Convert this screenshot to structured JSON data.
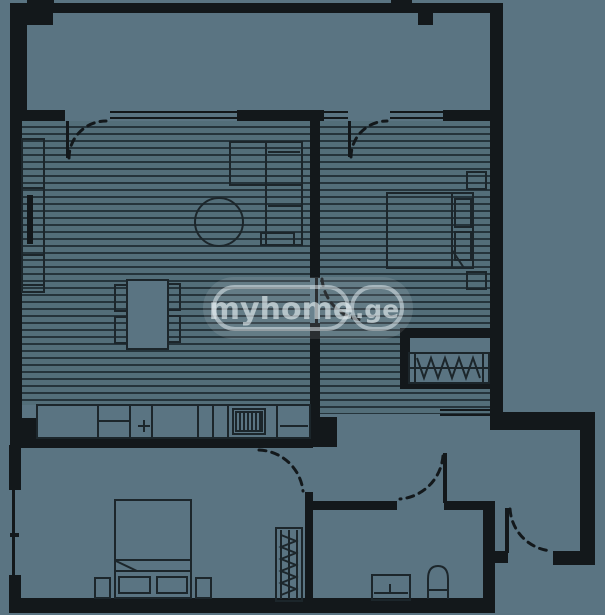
{
  "watermark": {
    "brand": "myhome",
    "tld": ".ge"
  },
  "palette": {
    "background": "#5a7482",
    "floor": "#536e79",
    "hatch_line": "#25343b",
    "wall": "#13181b",
    "furniture_line": "#1c262b",
    "watermark": "#e9f2f5"
  },
  "plan_elements": [
    "balcony",
    "living-room-with-kitchen",
    "bedroom-1",
    "bedroom-1-closet-nook",
    "bedroom-2",
    "hallway",
    "bathroom",
    "entrance-vestibule",
    "tv-unit",
    "l-shaped-sofa",
    "round-coffee-table",
    "dining-table-with-4-chairs",
    "kitchen-counter-with-sink-and-hob",
    "double-bed-with-pillows-and-nightstands",
    "hanging-rail-wardrobes",
    "bathroom-sink",
    "toilet",
    "balcony-doors",
    "interior-doors",
    "entrance-door",
    "windows"
  ]
}
